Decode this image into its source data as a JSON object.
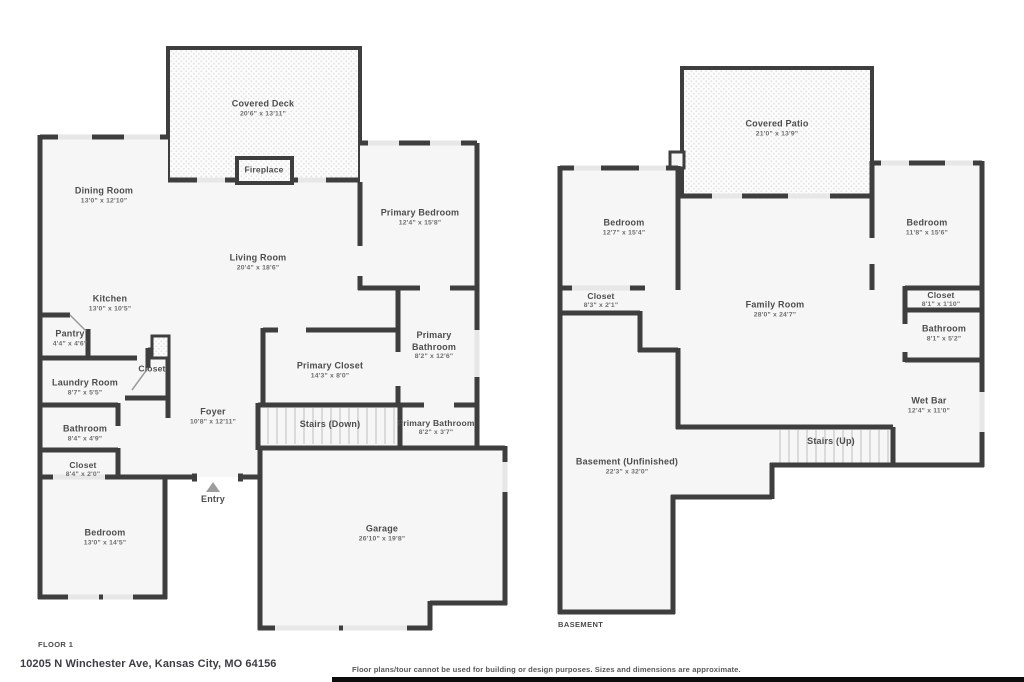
{
  "page": {
    "address": "10205 N Winchester Ave, Kansas City, MO 64156",
    "disclaimer": "Floor plans/tour cannot be used for building or design purposes. Sizes and dimensions are approximate."
  },
  "colors": {
    "wall": "#3e3e3e",
    "room_fill": "#f6f6f6",
    "window": "#e7e7e7",
    "deck_dot": "#e2e2e2"
  },
  "floor1": {
    "label": "FLOOR 1",
    "rooms": [
      {
        "name": "Covered Deck",
        "dims": "20'6\" x 13'11\""
      },
      {
        "name": "Fireplace",
        "dims": ""
      },
      {
        "name": "Dining Room",
        "dims": "13'0\" x 12'10\""
      },
      {
        "name": "Primary Bedroom",
        "dims": "12'4\" x 15'8\""
      },
      {
        "name": "Living Room",
        "dims": "20'4\" x 18'6\""
      },
      {
        "name": "Kitchen",
        "dims": "13'0\" x 10'5\""
      },
      {
        "name": "Pantry",
        "dims": "4'4\" x 4'6\""
      },
      {
        "name": "Primary Bathroom",
        "dims": "8'2\" x 12'6\""
      },
      {
        "name": "Primary Closet",
        "dims": "14'3\" x 8'0\""
      },
      {
        "name": "Laundry Room",
        "dims": "8'7\" x 5'5\""
      },
      {
        "name": "Closet",
        "dims": ""
      },
      {
        "name": "Foyer",
        "dims": "10'8\" x 12'11\""
      },
      {
        "name": "Stairs (Down)",
        "dims": ""
      },
      {
        "name": "Primary Bathroom",
        "dims": "8'2\" x 3'7\""
      },
      {
        "name": "Bathroom",
        "dims": "8'4\" x 4'9\""
      },
      {
        "name": "Closet",
        "dims": "8'4\" x 2'0\""
      },
      {
        "name": "Entry",
        "dims": ""
      },
      {
        "name": "Bedroom",
        "dims": "13'0\" x 14'5\""
      },
      {
        "name": "Garage",
        "dims": "26'10\" x 19'8\""
      }
    ]
  },
  "basement": {
    "label": "BASEMENT",
    "rooms": [
      {
        "name": "Covered Patio",
        "dims": "21'0\" x 13'9\""
      },
      {
        "name": "Bedroom",
        "dims": "12'7\" x 15'4\""
      },
      {
        "name": "Bedroom",
        "dims": "11'8\" x 15'6\""
      },
      {
        "name": "Closet",
        "dims": "8'3\" x 2'1\""
      },
      {
        "name": "Family Room",
        "dims": "28'0\" x 24'7\""
      },
      {
        "name": "Closet",
        "dims": "8'1\" x 1'10\""
      },
      {
        "name": "Bathroom",
        "dims": "8'1\" x 5'2\""
      },
      {
        "name": "Wet Bar",
        "dims": "12'4\" x 11'0\""
      },
      {
        "name": "Stairs (Up)",
        "dims": ""
      },
      {
        "name": "Basement (Unfinished)",
        "dims": "22'3\" x 32'0\""
      }
    ]
  }
}
